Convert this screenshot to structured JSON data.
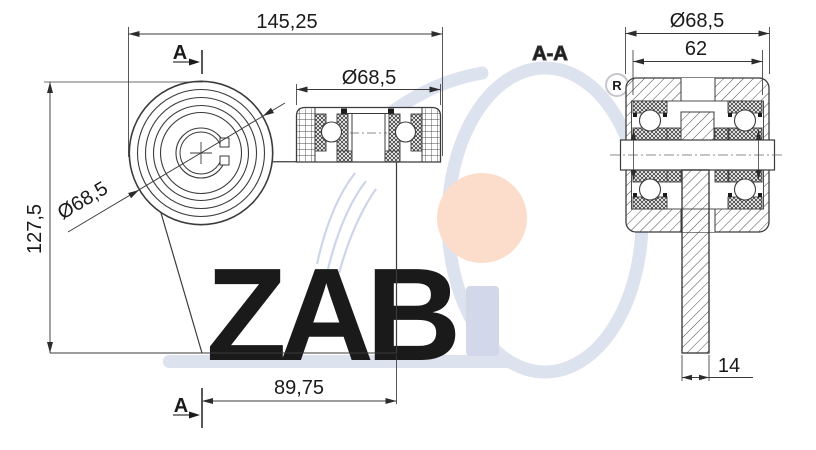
{
  "window": {
    "width": 816,
    "height": 450
  },
  "drawing": {
    "front_view": {
      "section_marker": "A",
      "dim_overall_width": "145,25",
      "dim_overall_height": "127,5",
      "dim_wheel_diameter": "Ø68,5",
      "dim_axle_offset": "89,75"
    },
    "side_view": {
      "dim_wheel_diameter": "Ø68,5"
    },
    "section_view": {
      "label": "A-A",
      "dim_wheel_diameter": "Ø68,5",
      "dim_hub_width": "62",
      "dim_plate_thickness": "14"
    }
  },
  "watermark": {
    "brand": "ZABi",
    "brand_letters": "ZAB",
    "registered_mark": "R",
    "letters_color": "#d2d8e9",
    "swoosh_color": "#dde2ef",
    "dot_color": "#fcdcca",
    "accent_arc_color": "#ccd5e9"
  },
  "canvas": {
    "background": "#ffffff",
    "line_color": "#3b3b3b"
  }
}
